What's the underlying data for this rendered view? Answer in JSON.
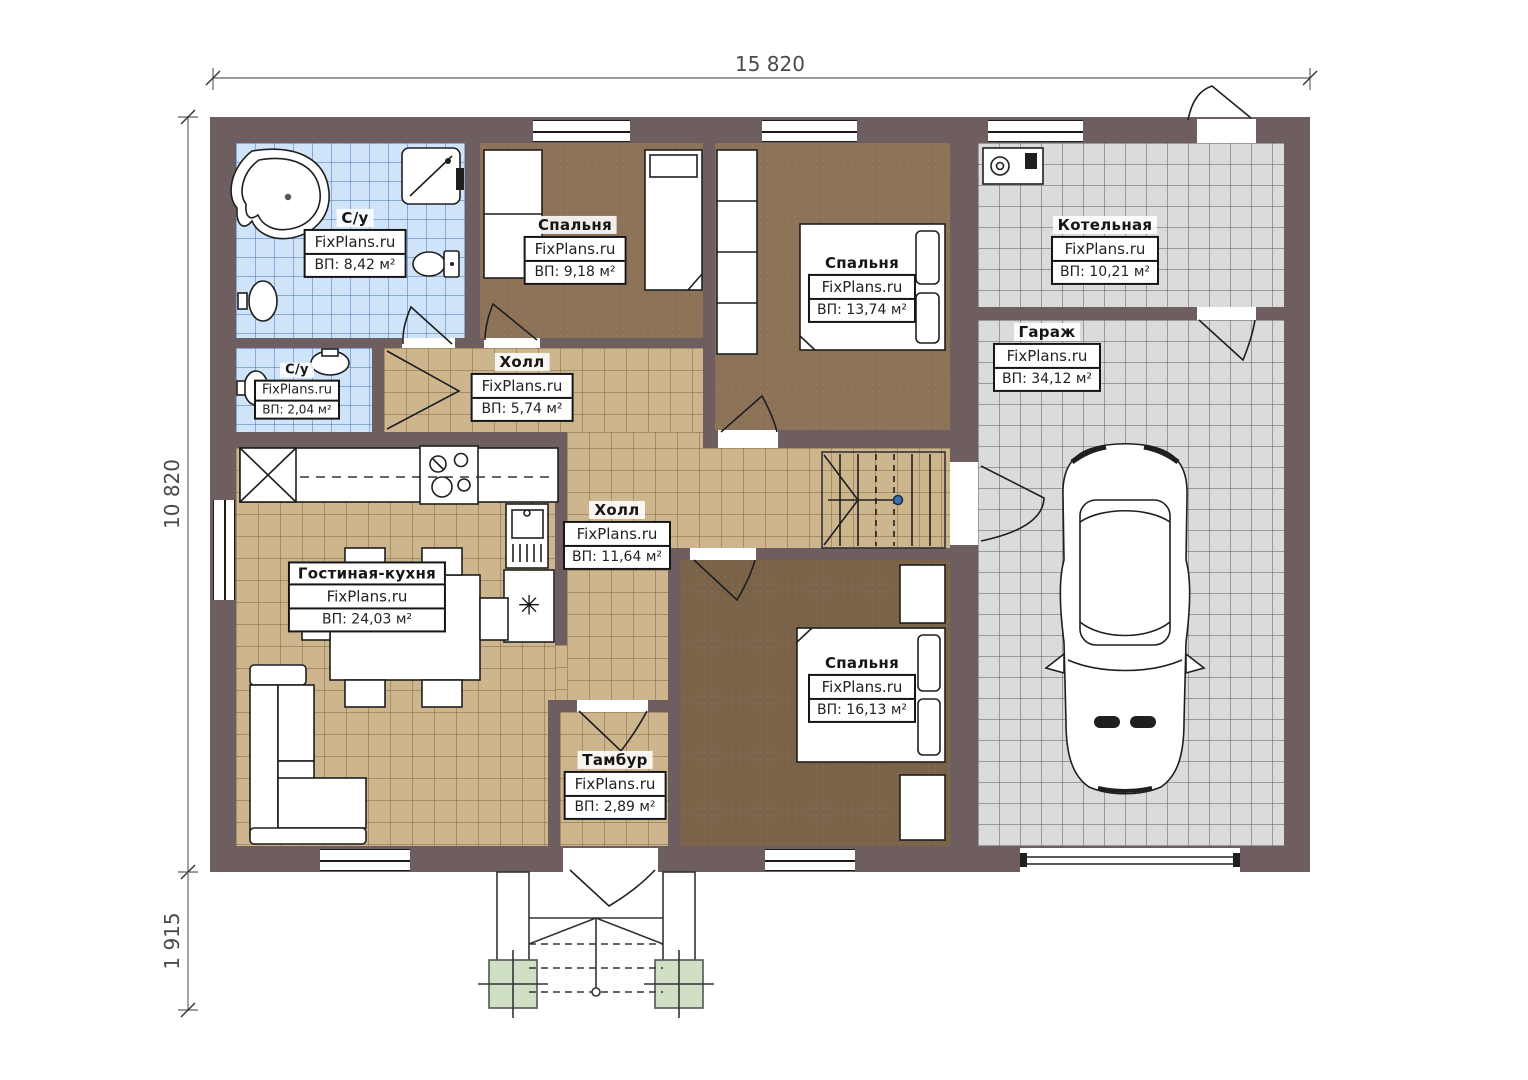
{
  "watermark": "FixPlans.ru",
  "dimensions": {
    "top_width": "15 820",
    "left_height": "10 820",
    "porch_height": "1 915"
  },
  "rooms": {
    "bath_main": {
      "name": "С/у",
      "area": "ВП: 8,42 м²"
    },
    "bath_small": {
      "name": "С/у",
      "area": "ВП: 2,04 м²"
    },
    "bedroom_1": {
      "name": "Спальня",
      "area": "ВП: 9,18 м²"
    },
    "bedroom_2": {
      "name": "Спальня",
      "area": "ВП: 13,74 м²"
    },
    "boiler": {
      "name": "Котельная",
      "area": "ВП: 10,21 м²"
    },
    "garage": {
      "name": "Гараж",
      "area": "ВП: 34,12 м²"
    },
    "hall_small": {
      "name": "Холл",
      "area": "ВП: 5,74 м²"
    },
    "hall_big": {
      "name": "Холл",
      "area": "ВП: 11,64 м²"
    },
    "living_kitchen": {
      "name": "Гостиная-кухня",
      "area": "ВП: 24,03 м²"
    },
    "bedroom_3": {
      "name": "Спальня",
      "area": "ВП: 16,13 м²"
    },
    "tambur": {
      "name": "Тамбур",
      "area": "ВП: 2,89 м²"
    }
  },
  "fixtures": {
    "fridge_symbol": "✳"
  },
  "colors": {
    "wall": "#6f5e5f",
    "tile_blue": "#cfe4f8",
    "tile_tan": "#cdb68d",
    "tile_gray": "#dbdbdb",
    "floor_brown": "#8c7257",
    "floor_brown_dark": "#7b634a",
    "pad_green": "#cfe0c4",
    "dot": "#3b6fb5"
  }
}
